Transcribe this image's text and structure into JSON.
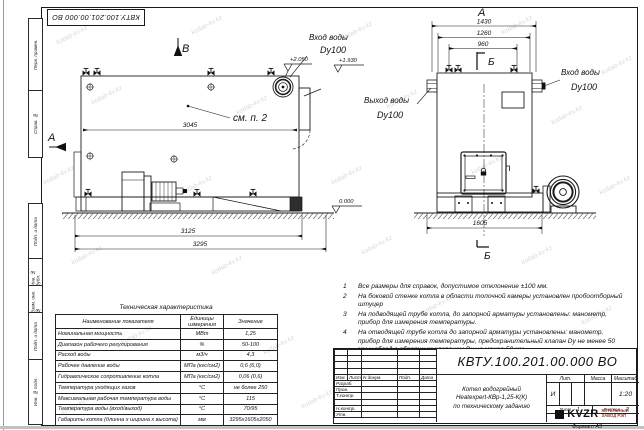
{
  "watermark": "kotlab-kv.kz",
  "frame": {
    "top_stamp": "КВТУ.100.201.00.000 ВО",
    "side_labels": [
      "Перв. примен.",
      "Справ. №",
      "Подп. и дата",
      "Инв. № дубл.",
      "Взам. инв. №",
      "Подп. и дата",
      "Инв. № подл."
    ],
    "format_note": "Формат  А3"
  },
  "side_view": {
    "view_letter_top": "В",
    "view_letter_left": "А",
    "callout": "см. п. 2",
    "dim_body": "3045",
    "dim_frame": "3125",
    "dim_total": "3295",
    "elev_top": "+2.050",
    "elev_pipe": "+1.930",
    "elev_ground": "0.000",
    "inlet_line1": "Вход воды",
    "inlet_line2": "Dy100"
  },
  "front_view": {
    "view_letter": "А",
    "section_letter": "Б",
    "dim_1": "1430",
    "dim_2": "1260",
    "dim_3": "960",
    "dim_base": "1605",
    "outlet_line1": "Выход воды",
    "outlet_line2": "Dy100",
    "inlet_line1": "Вход воды",
    "inlet_line2": "Dy100"
  },
  "notes": [
    {
      "num": "1",
      "text": "Все размеры для справок, допустимое отклонение ±100 мм."
    },
    {
      "num": "2",
      "text": "На боковой стенке котла в области топочной камеры установлен пробоотборный штуцер"
    },
    {
      "num": "3",
      "text": "На подводящей трубе котла, до запорной арматуры установлены: манометр, прибор для измерения температуры."
    },
    {
      "num": "4",
      "text": "На отводящей трубе котла до запорной арматуры установлены: манометр, прибор для измерения температуры, предохранительный клапан Dy не менее 50 мм и обвод с обратным клапаном Dy не менее 50 мм."
    }
  ],
  "spec_table": {
    "title": "Техническая характеристика",
    "headers": [
      "Наименование показателя",
      "Единицы измерения",
      "Значение"
    ],
    "rows": [
      [
        "Номинальная мощность",
        "МВт",
        "1,25"
      ],
      [
        "Диапазон рабочего регулирования",
        "%",
        "50-100"
      ],
      [
        "Расход воды",
        "м3/ч",
        "4,3"
      ],
      [
        "Рабочее давление воды",
        "МПа (кгс/см2)",
        "0,6 (6,0)"
      ],
      [
        "Гидравлическое сопротивление котла",
        "МПа (кгс/см2)",
        "0,06 (0,6)"
      ],
      [
        "Температура уходящих газов",
        "°С",
        "не более 250"
      ],
      [
        "Максимальная рабочая температура воды",
        "°С",
        "115"
      ],
      [
        "Температура воды (вход/выход)",
        "°С",
        "70/95"
      ],
      [
        "Габариты котла (длинна х ширина х высота)",
        "мм",
        "3295х1605х2050"
      ]
    ]
  },
  "title_block": {
    "doc_number": "КВТУ.100.201.00.000  ВО",
    "rev_headers": [
      "Изм.",
      "Лист",
      "N докум.",
      "Подп.",
      "Дата"
    ],
    "sig_labels": [
      "Разраб.",
      "Пров.",
      "Т.контр.",
      "",
      "Н.контр.",
      "Утв."
    ],
    "description": [
      "Котел водогрейный",
      "Heatexpert-КВр-1,25-К(К)",
      "по техническому заданию"
    ],
    "lit_label": "Лит.",
    "lit_value": "И",
    "mass_label": "Масса",
    "scale_label": "Масштаб",
    "scale_value": "1:20",
    "sheet_label": "Лист",
    "sheet_value": "1",
    "sheets_label": "Листов",
    "sheets_value": "2",
    "logo_text": "KVZR",
    "logo_sub1": "КОТЕЛЬНЫЙ",
    "logo_sub2": "ЗАВОД РЭП"
  }
}
